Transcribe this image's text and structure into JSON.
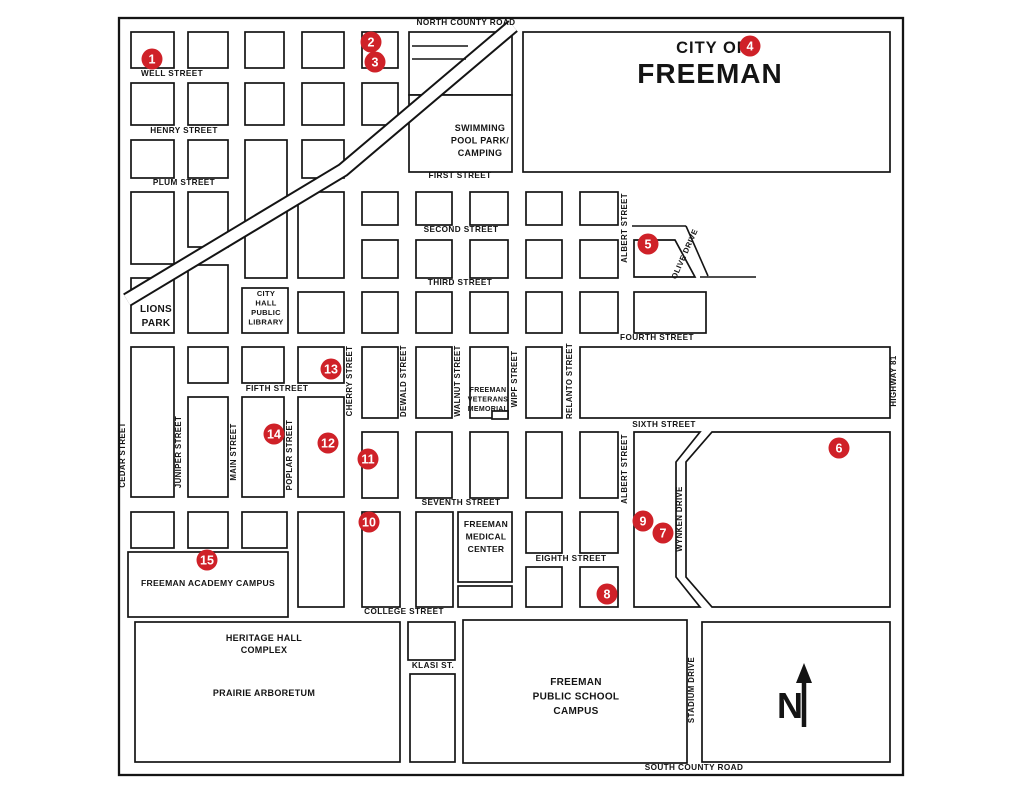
{
  "map_title": {
    "prefix": "CITY OF",
    "name": "FREEMAN"
  },
  "colors": {
    "ink": "#141414",
    "marker_red": "#cf2128",
    "marker_text": "#ffffff",
    "background": "#ffffff"
  },
  "canvas": {
    "width": 1024,
    "height": 791
  },
  "border": {
    "x": 119,
    "y": 18,
    "w": 784,
    "h": 757
  },
  "compass": {
    "letter": "N"
  },
  "railroad_points": [
    [
      127,
      300
    ],
    [
      343,
      170
    ],
    [
      513,
      26
    ]
  ],
  "blocks": [
    [
      131,
      32,
      43,
      36
    ],
    [
      188,
      32,
      40,
      36
    ],
    [
      245,
      32,
      39,
      36
    ],
    [
      302,
      32,
      42,
      36
    ],
    [
      362,
      32,
      36,
      36
    ],
    [
      409,
      32,
      103,
      63
    ],
    [
      131,
      83,
      43,
      42
    ],
    [
      188,
      83,
      40,
      42
    ],
    [
      245,
      83,
      39,
      42
    ],
    [
      302,
      83,
      42,
      42
    ],
    [
      362,
      83,
      36,
      42
    ],
    [
      131,
      140,
      43,
      38
    ],
    [
      188,
      140,
      40,
      38
    ],
    [
      245,
      140,
      42,
      138
    ],
    [
      302,
      140,
      42,
      38
    ],
    [
      409,
      95,
      103,
      77
    ],
    [
      523,
      32,
      367,
      140
    ],
    [
      131,
      192,
      43,
      72
    ],
    [
      188,
      192,
      40,
      55
    ],
    [
      298,
      192,
      46,
      86
    ],
    [
      362,
      192,
      36,
      33
    ],
    [
      131,
      278,
      43,
      55
    ],
    [
      188,
      265,
      40,
      68
    ],
    [
      242,
      288,
      46,
      45
    ],
    [
      298,
      292,
      46,
      41
    ],
    [
      362,
      292,
      36,
      41
    ],
    [
      362,
      240,
      36,
      38
    ],
    [
      416,
      192,
      36,
      33
    ],
    [
      470,
      192,
      38,
      33
    ],
    [
      526,
      192,
      36,
      33
    ],
    [
      580,
      192,
      38,
      33
    ],
    [
      416,
      240,
      36,
      38
    ],
    [
      470,
      240,
      38,
      38
    ],
    [
      526,
      240,
      36,
      38
    ],
    [
      580,
      240,
      38,
      38
    ],
    [
      416,
      292,
      36,
      41
    ],
    [
      470,
      292,
      38,
      41
    ],
    [
      526,
      292,
      36,
      41
    ],
    [
      580,
      292,
      38,
      41
    ],
    [
      634,
      292,
      72,
      41
    ],
    [
      362,
      347,
      36,
      71
    ],
    [
      416,
      347,
      36,
      71
    ],
    [
      470,
      347,
      38,
      71
    ],
    [
      526,
      347,
      36,
      71
    ],
    [
      580,
      347,
      310,
      71
    ],
    [
      131,
      347,
      43,
      150
    ],
    [
      188,
      347,
      40,
      36
    ],
    [
      242,
      347,
      42,
      36
    ],
    [
      298,
      347,
      46,
      36
    ],
    [
      188,
      397,
      40,
      100
    ],
    [
      242,
      397,
      42,
      100
    ],
    [
      298,
      397,
      46,
      100
    ],
    [
      362,
      432,
      36,
      66
    ],
    [
      416,
      432,
      36,
      66
    ],
    [
      470,
      432,
      38,
      66
    ],
    [
      526,
      432,
      36,
      66
    ],
    [
      580,
      432,
      38,
      66
    ],
    [
      131,
      512,
      43,
      36
    ],
    [
      188,
      512,
      40,
      36
    ],
    [
      242,
      512,
      45,
      36
    ],
    [
      298,
      512,
      46,
      95
    ],
    [
      362,
      512,
      38,
      95
    ],
    [
      416,
      512,
      37,
      95
    ],
    [
      458,
      512,
      54,
      70
    ],
    [
      458,
      586,
      54,
      21
    ],
    [
      526,
      512,
      36,
      41
    ],
    [
      580,
      512,
      38,
      41
    ],
    [
      526,
      567,
      36,
      40
    ],
    [
      580,
      567,
      38,
      40
    ],
    [
      128,
      552,
      160,
      65
    ],
    [
      135,
      622,
      265,
      140
    ],
    [
      408,
      622,
      47,
      38
    ],
    [
      410,
      674,
      45,
      88
    ],
    [
      463,
      620,
      224,
      143
    ],
    [
      702,
      622,
      188,
      140
    ],
    [
      492,
      411,
      16,
      8
    ]
  ],
  "polygons": [
    "634,240 675,240 695,277 634,277",
    "634,432 700,432 676,462 676,577 700,607 634,607",
    "712,432 890,432 890,607 712,607 686,577 686,462"
  ],
  "extra_lines": [
    [
      632,
      226,
      686,
      226
    ],
    [
      686,
      226,
      708,
      276
    ],
    [
      700,
      277,
      756,
      277
    ],
    [
      412,
      46,
      468,
      46
    ],
    [
      412,
      59,
      466,
      59
    ]
  ],
  "street_labels": [
    {
      "text": "NORTH COUNTY ROAD",
      "x": 466,
      "y": 25,
      "rotate": 0,
      "size": 8.2
    },
    {
      "text": "WELL STREET",
      "x": 172,
      "y": 76,
      "rotate": 0,
      "size": 8.2
    },
    {
      "text": "HENRY STREET",
      "x": 184,
      "y": 133,
      "rotate": 0,
      "size": 8.2
    },
    {
      "text": "PLUM STREET",
      "x": 184,
      "y": 185,
      "rotate": 0,
      "size": 8.2
    },
    {
      "text": "FIRST STREET",
      "x": 460,
      "y": 178,
      "rotate": 0,
      "size": 8.2
    },
    {
      "text": "SECOND STREET",
      "x": 461,
      "y": 232,
      "rotate": 0,
      "size": 8.2
    },
    {
      "text": "THIRD STREET",
      "x": 460,
      "y": 285,
      "rotate": 0,
      "size": 8.2
    },
    {
      "text": "FOURTH STREET",
      "x": 657,
      "y": 340,
      "rotate": 0,
      "size": 8.2
    },
    {
      "text": "FIFTH STREET",
      "x": 277,
      "y": 391,
      "rotate": 0,
      "size": 8.2
    },
    {
      "text": "SIXTH STREET",
      "x": 664,
      "y": 427,
      "rotate": 0,
      "size": 8.2
    },
    {
      "text": "SEVENTH STREET",
      "x": 461,
      "y": 505,
      "rotate": 0,
      "size": 8.2
    },
    {
      "text": "EIGHTH STREET",
      "x": 571,
      "y": 561,
      "rotate": 0,
      "size": 8.2
    },
    {
      "text": "COLLEGE STREET",
      "x": 404,
      "y": 614,
      "rotate": 0,
      "size": 8.2
    },
    {
      "text": "KLASI ST.",
      "x": 433,
      "y": 668,
      "rotate": 0,
      "size": 8.2
    },
    {
      "text": "SOUTH COUNTY ROAD",
      "x": 694,
      "y": 770,
      "rotate": 0,
      "size": 8.2
    },
    {
      "text": "CEDAR STREET",
      "x": 125,
      "y": 455,
      "rotate": -90,
      "size": 7.8
    },
    {
      "text": "JUNIPER STREET",
      "x": 181,
      "y": 452,
      "rotate": -90,
      "size": 7.8
    },
    {
      "text": "MAIN STREET",
      "x": 236,
      "y": 452,
      "rotate": -90,
      "size": 7.8
    },
    {
      "text": "POPLAR STREET",
      "x": 292,
      "y": 455,
      "rotate": -90,
      "size": 7.8
    },
    {
      "text": "CHERRY STREET",
      "x": 352,
      "y": 381,
      "rotate": -90,
      "size": 7.8
    },
    {
      "text": "DEWALD STREET",
      "x": 406,
      "y": 381,
      "rotate": -90,
      "size": 7.8
    },
    {
      "text": "WALNUT STREET",
      "x": 460,
      "y": 381,
      "rotate": -90,
      "size": 7.8
    },
    {
      "text": "WIPF STREET",
      "x": 517,
      "y": 379,
      "rotate": -90,
      "size": 7.8
    },
    {
      "text": "RELANTO STREET",
      "x": 572,
      "y": 381,
      "rotate": -90,
      "size": 7.8
    },
    {
      "text": "ALBERT STREET",
      "x": 627,
      "y": 228,
      "rotate": -90,
      "size": 7.8
    },
    {
      "text": "ALBERT STREET",
      "x": 627,
      "y": 469,
      "rotate": -90,
      "size": 7.8
    },
    {
      "text": "OLIVE DRIVE",
      "x": 687,
      "y": 255,
      "rotate": -66,
      "size": 7.8
    },
    {
      "text": "WYNKEN DRIVE",
      "x": 682,
      "y": 519,
      "rotate": -90,
      "size": 7.8
    },
    {
      "text": "STADIUM DRIVE",
      "x": 694,
      "y": 690,
      "rotate": -90,
      "size": 7.8
    },
    {
      "text": "HIGHWAY 81",
      "x": 896,
      "y": 381,
      "rotate": -90,
      "size": 7.8
    }
  ],
  "area_labels": [
    {
      "id": "swimming-pool-park",
      "lines": [
        "SWIMMING",
        "POOL PARK/",
        "CAMPING"
      ],
      "x": 480,
      "y": 131,
      "size": 9,
      "lh": 12.5
    },
    {
      "id": "lions-park",
      "lines": [
        "LIONS",
        "PARK"
      ],
      "x": 156,
      "y": 312,
      "size": 10,
      "lh": 14
    },
    {
      "id": "city-hall-public-library",
      "lines": [
        "CITY",
        "HALL",
        "PUBLIC",
        "LIBRARY"
      ],
      "x": 266,
      "y": 296,
      "size": 7.5,
      "lh": 9.5
    },
    {
      "id": "freeman-veterans-memorial",
      "lines": [
        "FREEMAN",
        "VETERANS",
        "MEMORIAL"
      ],
      "x": 488,
      "y": 392,
      "size": 7,
      "lh": 9.5
    },
    {
      "id": "freeman-medical-center",
      "lines": [
        "FREEMAN",
        "MEDICAL",
        "CENTER"
      ],
      "x": 486,
      "y": 527,
      "size": 8.5,
      "lh": 12.5
    },
    {
      "id": "freeman-academy-campus",
      "lines": [
        "FREEMAN ACADEMY CAMPUS"
      ],
      "x": 208,
      "y": 586,
      "size": 8.6,
      "lh": 12
    },
    {
      "id": "heritage-hall-complex",
      "lines": [
        "HERITAGE HALL",
        "COMPLEX"
      ],
      "x": 264,
      "y": 641,
      "size": 9,
      "lh": 12
    },
    {
      "id": "prairie-arboretum",
      "lines": [
        "PRAIRIE ARBORETUM"
      ],
      "x": 264,
      "y": 696,
      "size": 9,
      "lh": 12
    },
    {
      "id": "freeman-public-school-campus",
      "lines": [
        "FREEMAN",
        "PUBLIC SCHOOL",
        "CAMPUS"
      ],
      "x": 576,
      "y": 685,
      "size": 10,
      "lh": 14.5
    }
  ],
  "markers": [
    {
      "n": "1",
      "x": 152,
      "y": 59
    },
    {
      "n": "2",
      "x": 371,
      "y": 42
    },
    {
      "n": "3",
      "x": 375,
      "y": 62
    },
    {
      "n": "4",
      "x": 750,
      "y": 46
    },
    {
      "n": "5",
      "x": 648,
      "y": 244
    },
    {
      "n": "6",
      "x": 839,
      "y": 448
    },
    {
      "n": "7",
      "x": 663,
      "y": 533
    },
    {
      "n": "8",
      "x": 607,
      "y": 594
    },
    {
      "n": "9",
      "x": 643,
      "y": 521
    },
    {
      "n": "10",
      "x": 369,
      "y": 522
    },
    {
      "n": "11",
      "x": 368,
      "y": 459
    },
    {
      "n": "12",
      "x": 328,
      "y": 443
    },
    {
      "n": "13",
      "x": 331,
      "y": 369
    },
    {
      "n": "14",
      "x": 274,
      "y": 434
    },
    {
      "n": "15",
      "x": 207,
      "y": 560
    }
  ]
}
